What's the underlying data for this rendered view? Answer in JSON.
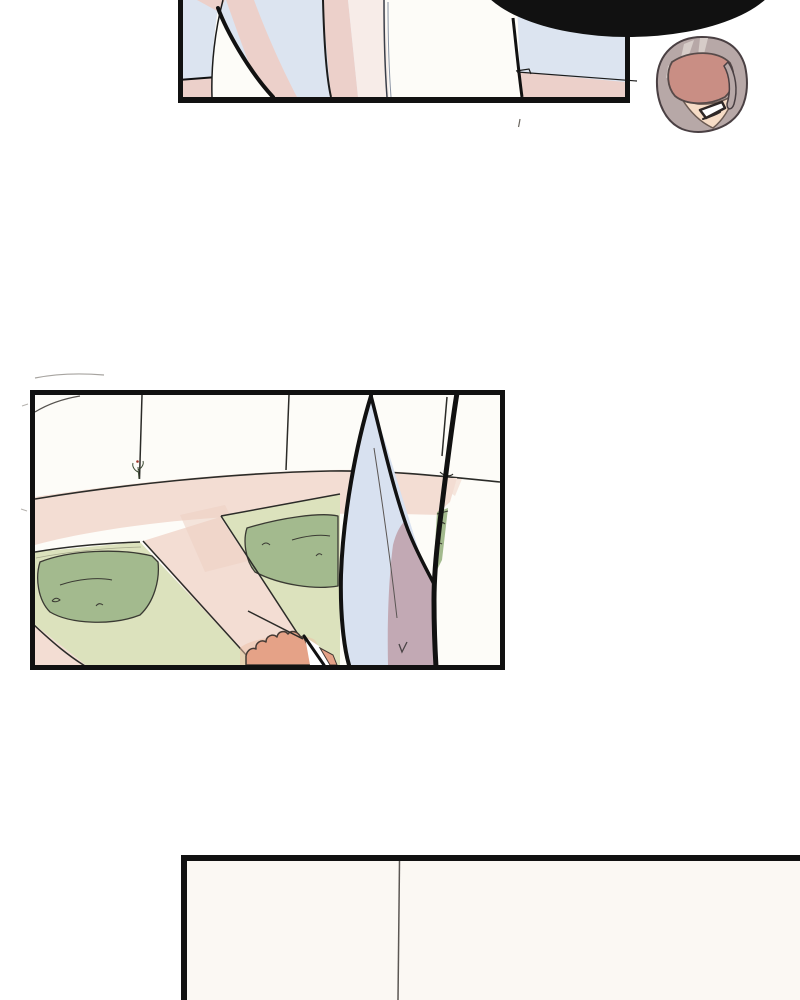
{
  "page": {
    "kind": "webtoon-episode-page",
    "description": "Vertical-scroll comic page with three bordered panels, no visible dialogue text",
    "background": "#ffffff"
  },
  "panels": [
    {
      "id": "panel-1",
      "position": "top, cropped by top edge of screen",
      "description": "Close-up of pale blue and pink draped shapes with a white blade form; a large solid black speech balloon is cropped at the top right corner"
    },
    {
      "id": "floating-head",
      "position": "top right, outside panel borders",
      "description": "Small floating head of a grey-haired character grinning with open mouth, eyes hidden under a rose-shadowed fringe"
    },
    {
      "id": "panel-2",
      "position": "middle left",
      "description": "Walled courtyard garden with curved white wall, pink paths, light green beds and darker hedges; a giant pale blue blade rises in the foreground and a tan hand grips near its base"
    },
    {
      "id": "panel-3",
      "position": "bottom, cropped by bottom edge of screen",
      "description": "Mostly empty cream interior wall divided by a single thin vertical seam line"
    }
  ],
  "speech_balloon": {
    "style": "solid black oval, contents not visible (cropped off-screen)"
  },
  "palette": {
    "ink": "#111111",
    "pageBg": "#ffffff",
    "panelWhite": "#fdfcf8",
    "skyBlue": "#dce4f0",
    "blushPink": "#ecd0ca",
    "blushPale": "#f7ece8",
    "pathPink": "#f3ddd3",
    "pathPinkDeep": "#eccfc3",
    "groundGreen": "#dce2bd",
    "hedgeGreen": "#a3ba8e",
    "bladeBlue": "#d8e1f0",
    "bladeMauve": "#c2a9b4",
    "handTan": "#e5a287",
    "handGlow": "#edbfa6",
    "hairGray": "#b7a8a7",
    "hairLight": "#d6ccc8",
    "hairOutline": "#4a4043",
    "faceRose": "#c98e84",
    "faceSkin": "#f6dcc6",
    "cream": "#fbf8f3",
    "sketch": "#2b2b28",
    "seamGray": "#5b5753"
  }
}
